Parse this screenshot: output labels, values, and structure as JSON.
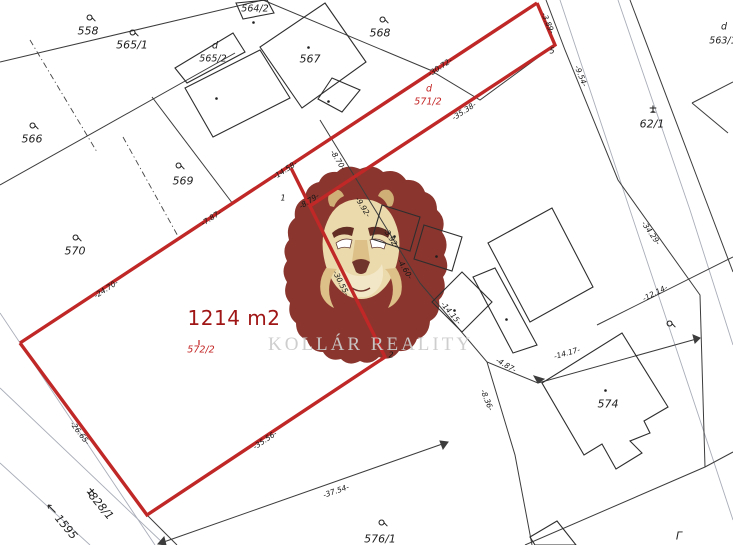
{
  "watermark": {
    "brand": "KOLLÁR REALITY",
    "lion": "lion-logo",
    "text_color": "#cccccc"
  },
  "colors": {
    "parcel_outline": "#c02727",
    "area_text": "#a01616",
    "red_text": "#c32323",
    "map_line": "#3c3c3c",
    "faint_line": "#a9adb8",
    "background": "#ffffff"
  },
  "highlight_parcel": {
    "number": "572/2",
    "area": "1214 m2"
  },
  "parcel_labels": [
    {
      "text": "558",
      "x": 88,
      "y": 31
    },
    {
      "text": "565/1",
      "x": 132,
      "y": 45
    },
    {
      "text": "564/2",
      "x": 255,
      "y": 9,
      "cls": "small"
    },
    {
      "text": "d",
      "x": 215,
      "y": 46,
      "cls": "small"
    },
    {
      "text": "565/2",
      "x": 213,
      "y": 59,
      "cls": "small"
    },
    {
      "text": "567",
      "x": 310,
      "y": 59
    },
    {
      "text": "568",
      "x": 380,
      "y": 33
    },
    {
      "text": "566",
      "x": 32,
      "y": 139
    },
    {
      "text": "569",
      "x": 183,
      "y": 181
    },
    {
      "text": "570",
      "x": 75,
      "y": 251
    },
    {
      "text": "d",
      "x": 724,
      "y": 27,
      "cls": "small"
    },
    {
      "text": "563/1",
      "x": 723,
      "y": 41,
      "cls": "small"
    },
    {
      "text": "62/1",
      "x": 652,
      "y": 124
    },
    {
      "text": "d",
      "x": 429,
      "y": 89,
      "cls": "red"
    },
    {
      "text": "571/2",
      "x": 428,
      "y": 102,
      "cls": "red"
    },
    {
      "text": "1214 m2",
      "x": 234,
      "y": 318,
      "cls": "area"
    },
    {
      "text": "572/2",
      "x": 201,
      "y": 350,
      "cls": "red"
    },
    {
      "text": "574",
      "x": 608,
      "y": 404
    },
    {
      "text": "576/1",
      "x": 380,
      "y": 539
    },
    {
      "text": "Γ",
      "x": 679,
      "y": 536
    },
    {
      "text": "573",
      "x": 687,
      "y": 551
    },
    {
      "text": "828/1",
      "x": 101,
      "y": 506,
      "rot": 50
    },
    {
      "text": "1595",
      "x": 66,
      "y": 527,
      "rot": 50
    }
  ],
  "measurements": [
    {
      "text": "-3.89-",
      "x": 548,
      "y": 23,
      "rot": 67
    },
    {
      "text": "-30.72-",
      "x": 440,
      "y": 67,
      "rot": -33
    },
    {
      "text": "-35.38-",
      "x": 464,
      "y": 111,
      "rot": -33
    },
    {
      "text": "-9.54-",
      "x": 581,
      "y": 76,
      "rot": 68
    },
    {
      "text": "-14.58-",
      "x": 285,
      "y": 170,
      "rot": -33
    },
    {
      "text": "-7.87-",
      "x": 211,
      "y": 218,
      "rot": -33
    },
    {
      "text": "-24.70-",
      "x": 106,
      "y": 289,
      "rot": -33
    },
    {
      "text": "-8.70-",
      "x": 338,
      "y": 160,
      "rot": 58
    },
    {
      "text": "-8.79-",
      "x": 309,
      "y": 201,
      "rot": -33
    },
    {
      "text": "-9.92-",
      "x": 363,
      "y": 207,
      "rot": 58
    },
    {
      "text": "-3.92-",
      "x": 391,
      "y": 238,
      "rot": 58
    },
    {
      "text": "-4.60-",
      "x": 405,
      "y": 269,
      "rot": 58
    },
    {
      "text": "-30.55-",
      "x": 341,
      "y": 283,
      "rot": 63
    },
    {
      "text": "-14.15-",
      "x": 451,
      "y": 313,
      "rot": 50
    },
    {
      "text": "-4.87-",
      "x": 506,
      "y": 365,
      "rot": 30
    },
    {
      "text": "-8.36-",
      "x": 487,
      "y": 400,
      "rot": 68
    },
    {
      "text": "-14.17-",
      "x": 567,
      "y": 353,
      "rot": -16
    },
    {
      "text": "-12.14-",
      "x": 655,
      "y": 293,
      "rot": -27
    },
    {
      "text": "-34.29-",
      "x": 651,
      "y": 233,
      "rot": 55
    },
    {
      "text": "-26.65-",
      "x": 80,
      "y": 433,
      "rot": 53
    },
    {
      "text": "-35.56-",
      "x": 265,
      "y": 440,
      "rot": -34
    },
    {
      "text": "-37.54-",
      "x": 336,
      "y": 491,
      "rot": -19
    }
  ],
  "vertex_labels": [
    {
      "text": "1",
      "x": 283,
      "y": 198
    },
    {
      "text": "2",
      "x": 391,
      "y": 355
    },
    {
      "text": "5",
      "x": 552,
      "y": 51
    }
  ],
  "symbols": [
    {
      "type": "grass",
      "x": 91,
      "y": 16
    },
    {
      "type": "grass",
      "x": 134,
      "y": 31
    },
    {
      "type": "grass",
      "x": 384,
      "y": 18
    },
    {
      "type": "grass",
      "x": 34,
      "y": 124
    },
    {
      "type": "grass",
      "x": 180,
      "y": 164
    },
    {
      "type": "grass",
      "x": 77,
      "y": 236
    },
    {
      "type": "grass",
      "x": 383,
      "y": 521
    },
    {
      "type": "grass",
      "x": 671,
      "y": 322
    },
    {
      "type": "club",
      "x": 653,
      "y": 107
    },
    {
      "type": "club",
      "x": 90,
      "y": 489,
      "rot": 50
    },
    {
      "type": "arrow",
      "x": 51,
      "y": 506
    },
    {
      "type": "tick",
      "x": 202,
      "y": 338
    },
    {
      "type": "dot",
      "x": 257,
      "y": 16
    },
    {
      "type": "dot",
      "x": 312,
      "y": 41
    },
    {
      "type": "dot",
      "x": 332,
      "y": 95
    },
    {
      "type": "dot",
      "x": 220,
      "y": 92
    },
    {
      "type": "dot",
      "x": 609,
      "y": 384
    },
    {
      "type": "dot",
      "x": 398,
      "y": 230
    },
    {
      "type": "dot",
      "x": 440,
      "y": 250
    },
    {
      "type": "dot",
      "x": 458,
      "y": 304
    },
    {
      "type": "dot",
      "x": 510,
      "y": 313
    },
    {
      "type": "dot",
      "x": 547,
      "y": 541
    }
  ]
}
